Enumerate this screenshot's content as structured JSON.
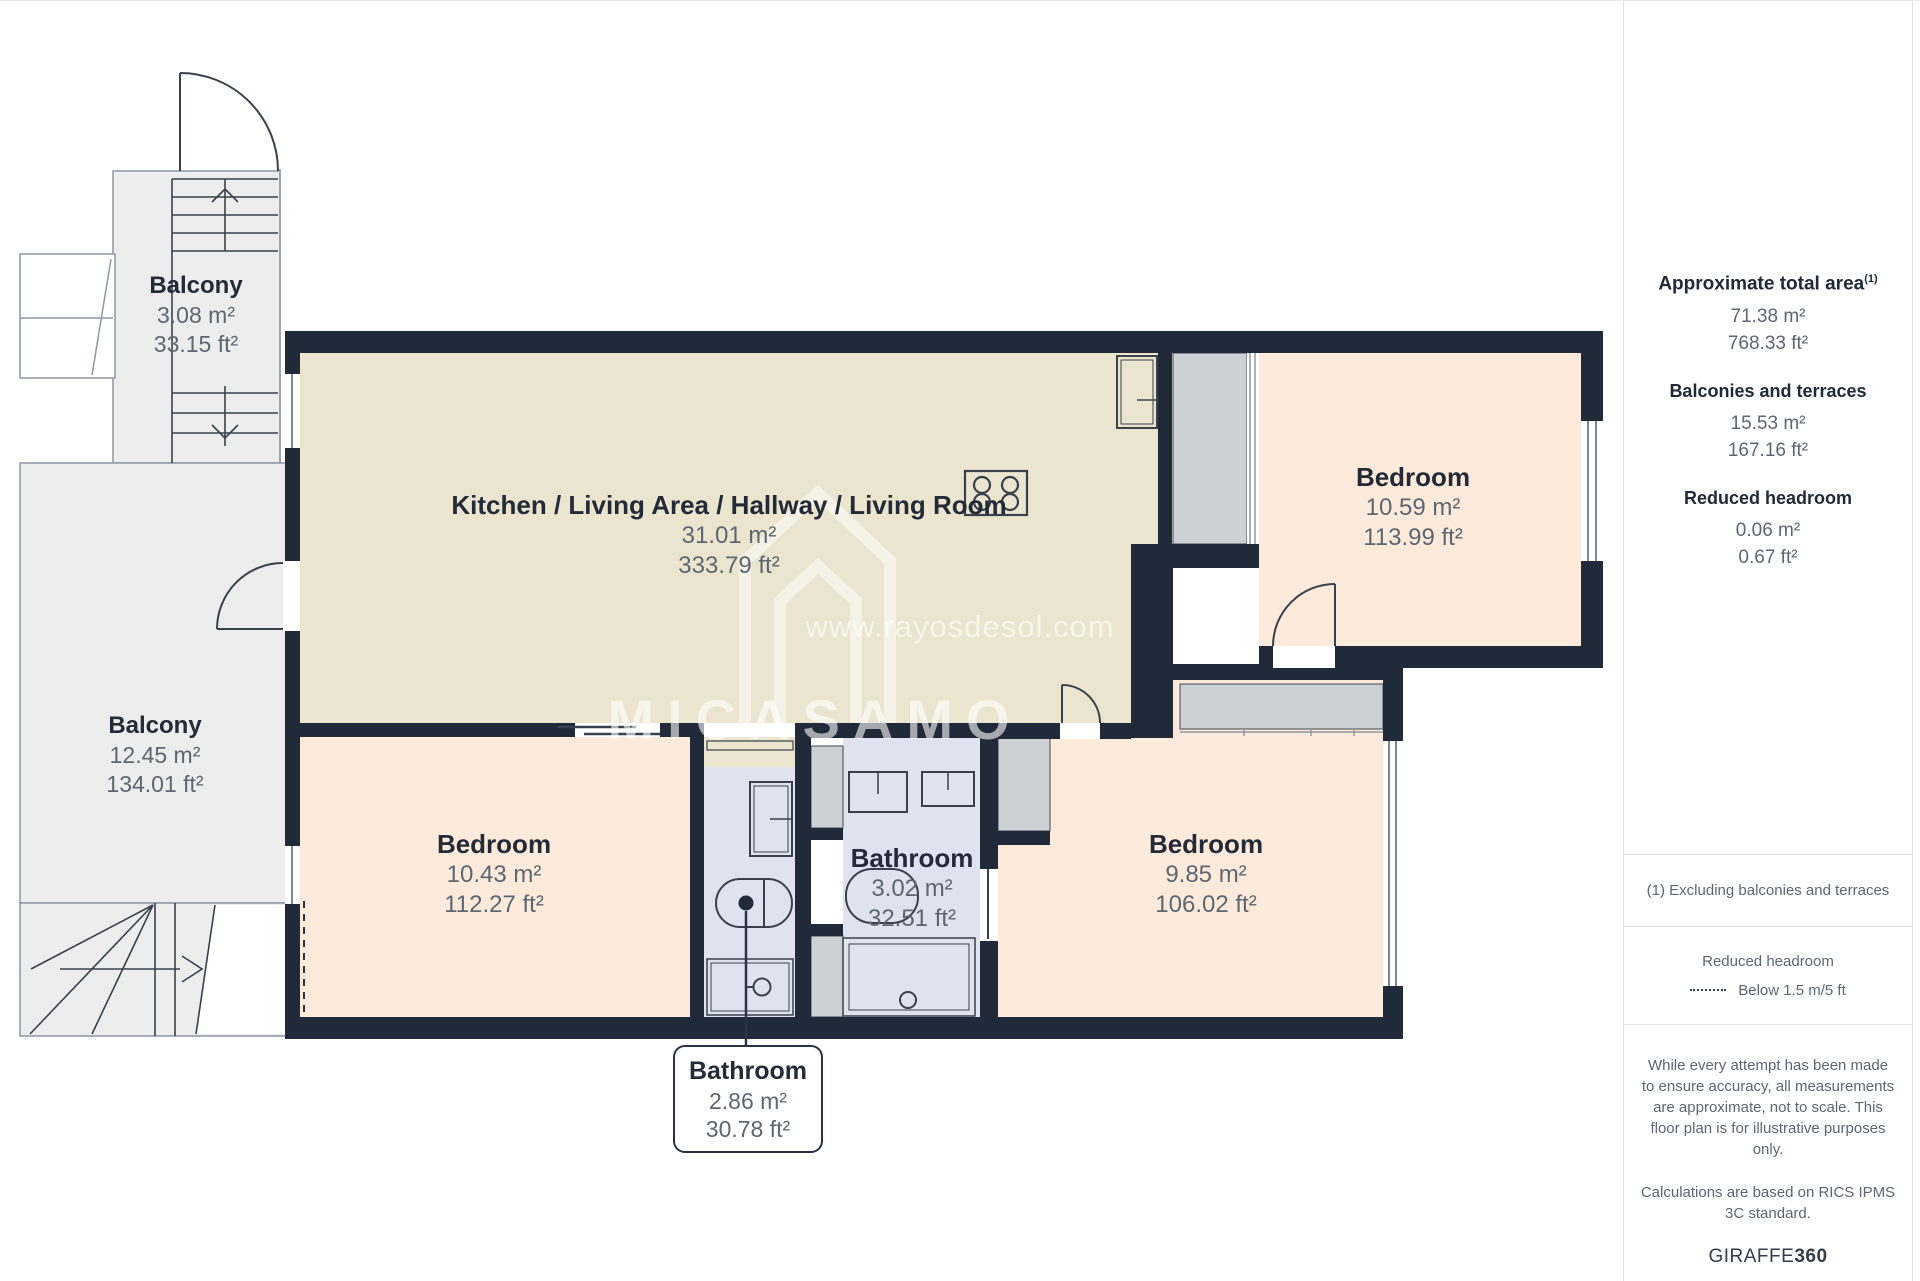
{
  "colors": {
    "wall": "#212a38",
    "room_beige": "#ebe5cf",
    "room_peach": "#fdeada",
    "room_bath_blue": "#dee3ef",
    "balcony_gray": "#ededee",
    "wardrobe_gray": "#ced1d4",
    "text_dark": "#232b39",
    "text_muted": "#5d6671",
    "divider": "#e4e4e4",
    "watermark": "rgba(255,255,255,0.6)"
  },
  "floorplan": {
    "rooms": {
      "kitchen": {
        "name": "Kitchen / Living Area / Hallway / Living Room",
        "area_m2": "31.01 m²",
        "area_ft2": "333.79 ft²"
      },
      "bedroom_tr": {
        "name": "Bedroom",
        "area_m2": "10.59 m²",
        "area_ft2": "113.99 ft²"
      },
      "bedroom_bl": {
        "name": "Bedroom",
        "area_m2": "10.43 m²",
        "area_ft2": "112.27 ft²"
      },
      "bathroom_main": {
        "name": "Bathroom",
        "area_m2": "3.02 m²",
        "area_ft2": "32.51 ft²"
      },
      "bedroom_br": {
        "name": "Bedroom",
        "area_m2": "9.85 m²",
        "area_ft2": "106.02 ft²"
      },
      "balcony_top": {
        "name": "Balcony",
        "area_m2": "3.08 m²",
        "area_ft2": "33.15 ft²"
      },
      "balcony_left": {
        "name": "Balcony",
        "area_m2": "12.45 m²",
        "area_ft2": "134.01 ft²"
      }
    },
    "callout": {
      "name": "Bathroom",
      "area_m2": "2.86 m²",
      "area_ft2": "30.78 ft²"
    },
    "watermark": {
      "url": "www.rayosdesol.com",
      "brand": "MICASAMO"
    }
  },
  "sidebar": {
    "total": {
      "label": "Approximate total area",
      "sup": "(1)",
      "m2": "71.38 m²",
      "ft2": "768.33 ft²"
    },
    "balconies": {
      "label": "Balconies and terraces",
      "m2": "15.53 m²",
      "ft2": "167.16 ft²"
    },
    "reduced": {
      "label": "Reduced headroom",
      "m2": "0.06 m²",
      "ft2": "0.67 ft²"
    },
    "footnote": "(1) Excluding balconies and terraces",
    "legend": {
      "title": "Reduced headroom",
      "item": "Below 1.5 m/5 ft"
    },
    "disclaimer1": "While every attempt has been made to ensure accuracy, all measurements are approximate, not to scale. This floor plan is for illustrative purposes only.",
    "disclaimer2": "Calculations are based on RICS IPMS 3C standard.",
    "logo": {
      "part1": "GIRAFFE",
      "part2": "360"
    }
  }
}
